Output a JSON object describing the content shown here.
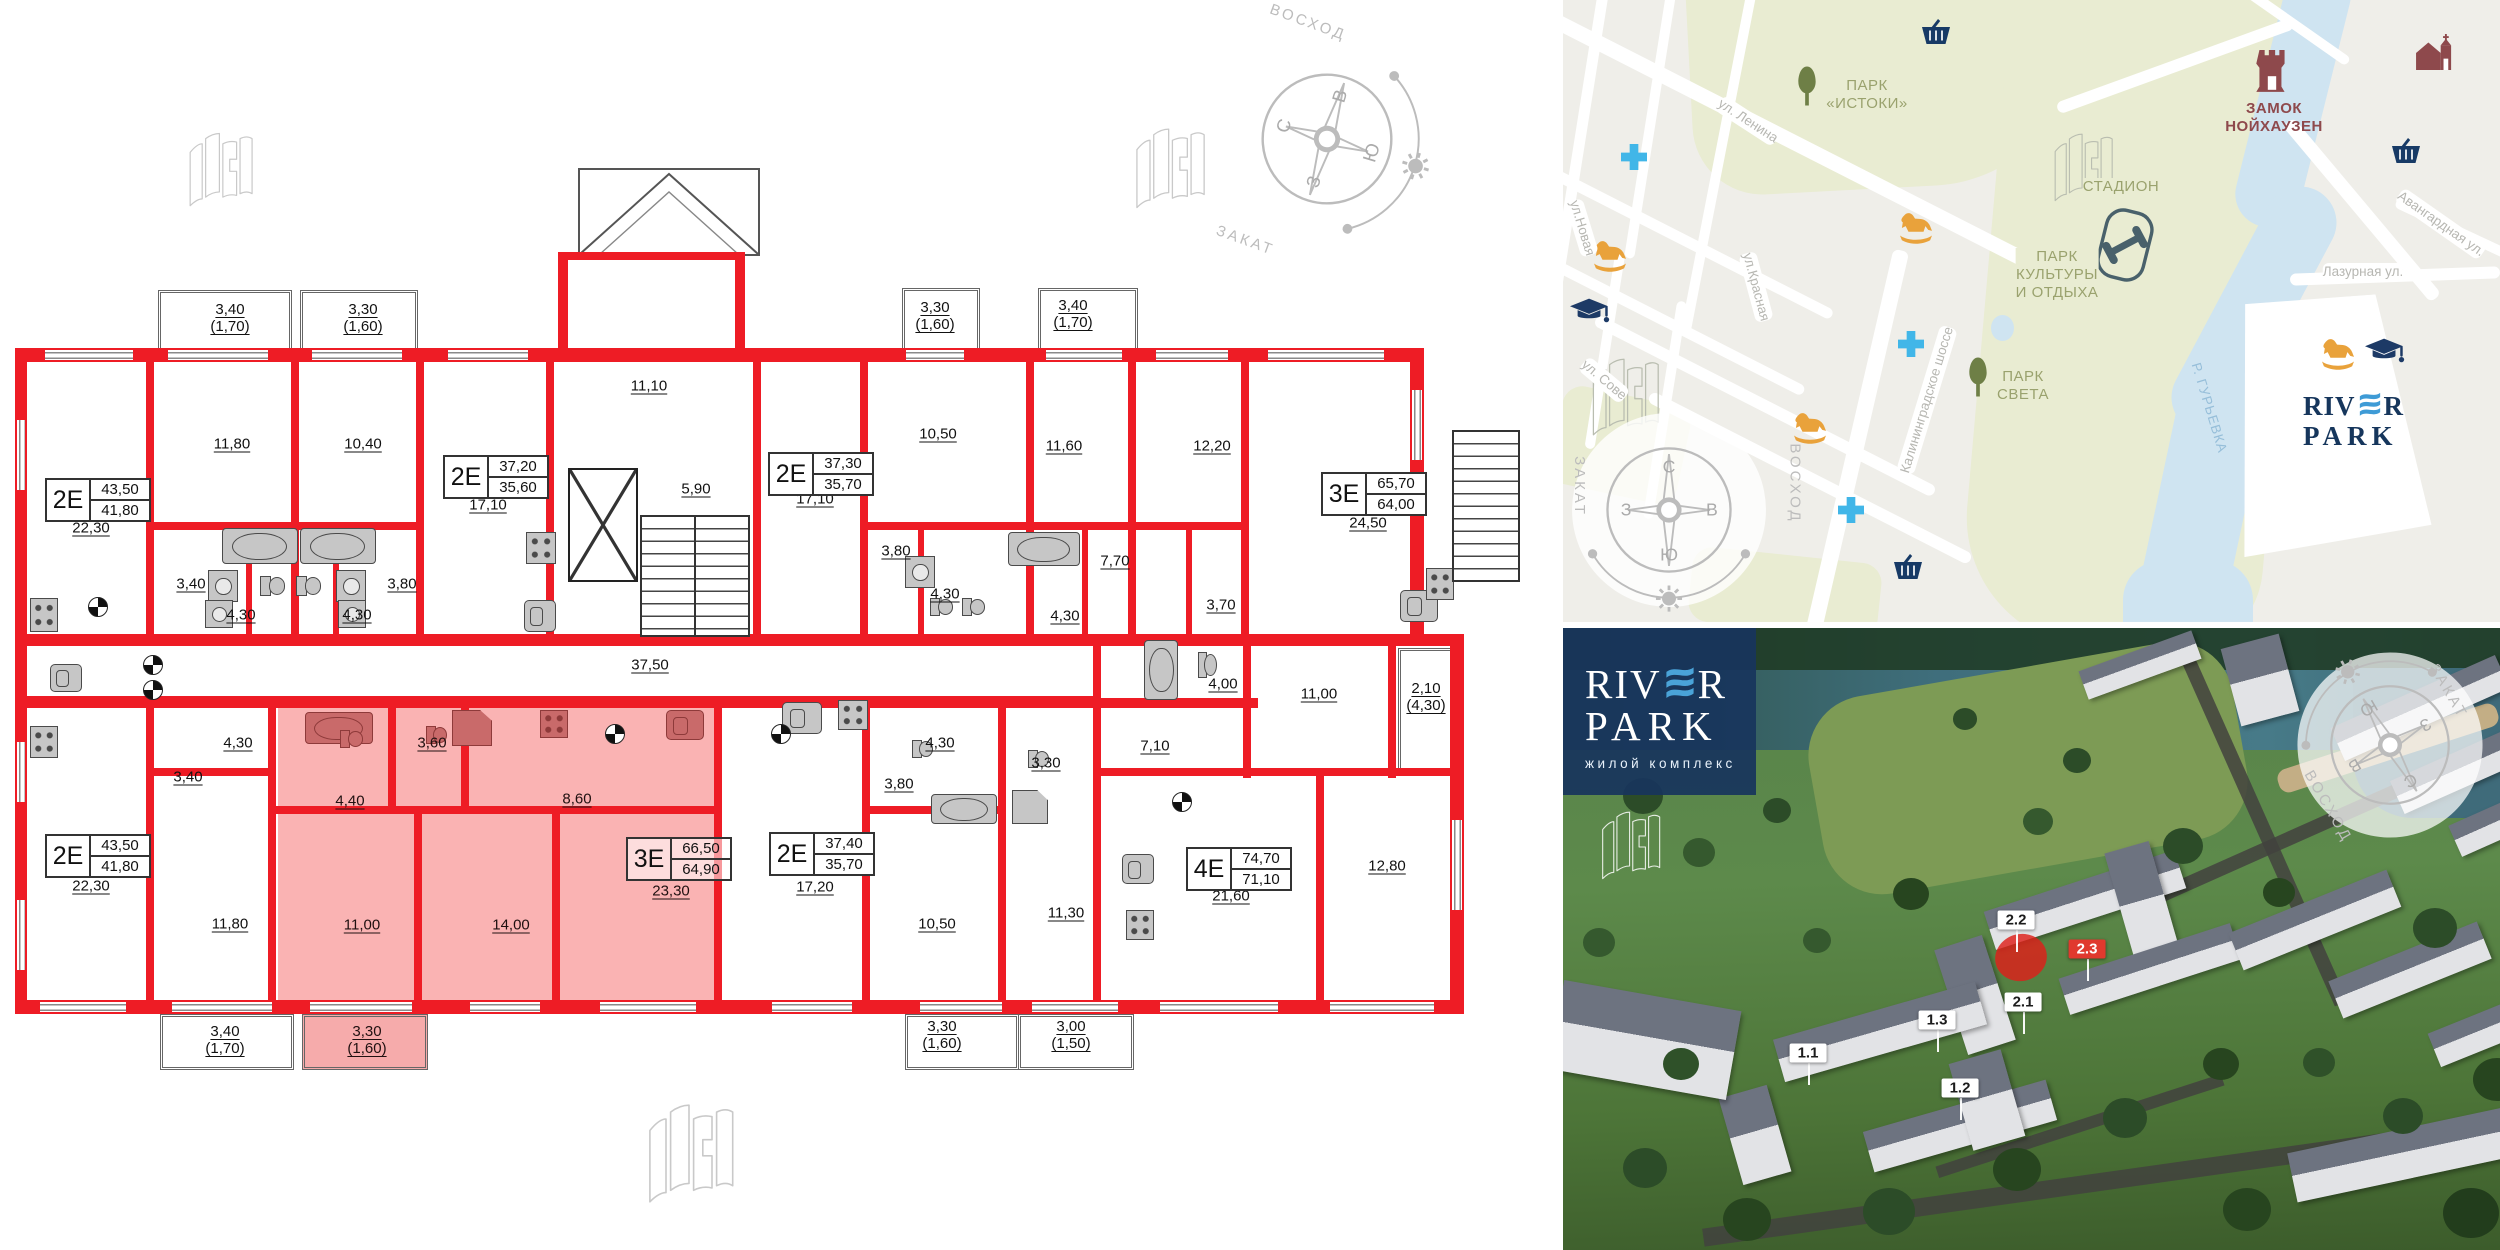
{
  "compass": {
    "north": "С",
    "east": "В",
    "south": "Ю",
    "west": "З",
    "sunrise": "ВОСХОД",
    "sunset": "ЗАКАТ"
  },
  "floor_plan": {
    "apartments": [
      {
        "code": "2Е",
        "area_total": "43,50",
        "area_living": "41,80",
        "x": 45,
        "y": 478
      },
      {
        "code": "2Е",
        "area_total": "37,20",
        "area_living": "35,60",
        "x": 443,
        "y": 455
      },
      {
        "code": "2Е",
        "area_total": "37,30",
        "area_living": "35,70",
        "x": 768,
        "y": 452
      },
      {
        "code": "3Е",
        "area_total": "65,70",
        "area_living": "64,00",
        "x": 1321,
        "y": 472
      },
      {
        "code": "2Е",
        "area_total": "43,50",
        "area_living": "41,80",
        "x": 45,
        "y": 834
      },
      {
        "code": "3Е",
        "area_total": "66,50",
        "area_living": "64,90",
        "x": 626,
        "y": 837,
        "highlighted": true
      },
      {
        "code": "2Е",
        "area_total": "37,40",
        "area_living": "35,70",
        "x": 769,
        "y": 832
      },
      {
        "code": "4Е",
        "area_total": "74,70",
        "area_living": "71,10",
        "x": 1186,
        "y": 847
      }
    ],
    "room_labels": [
      {
        "t": "22,30",
        "x": 91,
        "y": 528
      },
      {
        "t": "11,80",
        "x": 232,
        "y": 444
      },
      {
        "t": "10,40",
        "x": 363,
        "y": 444
      },
      {
        "t": "17,10",
        "x": 488,
        "y": 505
      },
      {
        "t": "3,40",
        "x": 191,
        "y": 584
      },
      {
        "t": "4,30",
        "x": 241,
        "y": 615
      },
      {
        "t": "4,30",
        "x": 357,
        "y": 615
      },
      {
        "t": "3,80",
        "x": 402,
        "y": 584
      },
      {
        "t": "11,10",
        "x": 649,
        "y": 386
      },
      {
        "t": "5,90",
        "x": 696,
        "y": 489
      },
      {
        "t": "17,10",
        "x": 815,
        "y": 499
      },
      {
        "t": "10,50",
        "x": 938,
        "y": 434
      },
      {
        "t": "3,80",
        "x": 896,
        "y": 551
      },
      {
        "t": "4,30",
        "x": 945,
        "y": 594
      },
      {
        "t": "11,60",
        "x": 1064,
        "y": 446
      },
      {
        "t": "12,20",
        "x": 1212,
        "y": 446
      },
      {
        "t": "24,50",
        "x": 1368,
        "y": 523
      },
      {
        "t": "7,70",
        "x": 1115,
        "y": 561
      },
      {
        "t": "4,30",
        "x": 1065,
        "y": 616
      },
      {
        "t": "3,70",
        "x": 1221,
        "y": 605
      },
      {
        "t": "37,50",
        "x": 650,
        "y": 665
      },
      {
        "t": "22,30",
        "x": 91,
        "y": 886
      },
      {
        "t": "3,40",
        "x": 188,
        "y": 777
      },
      {
        "t": "4,30",
        "x": 238,
        "y": 743
      },
      {
        "t": "11,80",
        "x": 230,
        "y": 924
      },
      {
        "t": "4,40",
        "x": 350,
        "y": 801,
        "hl": true
      },
      {
        "t": "3,60",
        "x": 432,
        "y": 743,
        "hl": true
      },
      {
        "t": "8,60",
        "x": 577,
        "y": 799,
        "hl": true
      },
      {
        "t": "11,00",
        "x": 362,
        "y": 925,
        "hl": true
      },
      {
        "t": "14,00",
        "x": 511,
        "y": 925,
        "hl": true
      },
      {
        "t": "23,30",
        "x": 671,
        "y": 891,
        "hl": true
      },
      {
        "t": "17,20",
        "x": 815,
        "y": 887
      },
      {
        "t": "3,80",
        "x": 899,
        "y": 784
      },
      {
        "t": "10,50",
        "x": 937,
        "y": 924
      },
      {
        "t": "4,30",
        "x": 940,
        "y": 743
      },
      {
        "t": "3,30",
        "x": 1046,
        "y": 763
      },
      {
        "t": "11,30",
        "x": 1066,
        "y": 913
      },
      {
        "t": "4,00",
        "x": 1223,
        "y": 684
      },
      {
        "t": "11,00",
        "x": 1319,
        "y": 694
      },
      {
        "t": "7,10",
        "x": 1155,
        "y": 746
      },
      {
        "t": "21,60",
        "x": 1231,
        "y": 896
      },
      {
        "t": "12,80",
        "x": 1387,
        "y": 866
      }
    ],
    "balcony_labels": [
      {
        "t": "3,40\n(1,70)",
        "x": 230,
        "y": 318
      },
      {
        "t": "3,30\n(1,60)",
        "x": 363,
        "y": 318
      },
      {
        "t": "3,30\n(1,60)",
        "x": 935,
        "y": 316
      },
      {
        "t": "3,40\n(1,70)",
        "x": 1073,
        "y": 314
      },
      {
        "t": "2,10\n(4,30)",
        "x": 1426,
        "y": 697
      },
      {
        "t": "3,40\n(1,70)",
        "x": 225,
        "y": 1040
      },
      {
        "t": "3,30\n(1,60)",
        "x": 367,
        "y": 1040,
        "hl": true
      },
      {
        "t": "3,30\n(1,60)",
        "x": 942,
        "y": 1035
      },
      {
        "t": "3,00\n(1,50)",
        "x": 1071,
        "y": 1035
      }
    ]
  },
  "map": {
    "labels": [
      {
        "t": "ПАРК\n«ИСТОКИ»",
        "x": 1867,
        "y": 95,
        "cls": "park"
      },
      {
        "t": "ПАРК\nКУЛЬТУРЫ\nИ ОТДЫХА",
        "x": 2057,
        "y": 275,
        "cls": "park"
      },
      {
        "t": "ПАРК\nСВЕТА",
        "x": 2023,
        "y": 386,
        "cls": "park"
      },
      {
        "t": "СТАДИОН",
        "x": 2121,
        "y": 187,
        "cls": "park"
      },
      {
        "t": "ЗАМОК\nНОЙХАУЗЕН",
        "x": 2274,
        "y": 118,
        "cls": "castle"
      },
      {
        "t": "ул. Ленина",
        "x": 1748,
        "y": 121,
        "rot": 33,
        "cls": "street"
      },
      {
        "t": "ул.Новая",
        "x": 1582,
        "y": 228,
        "rot": 73,
        "cls": "street"
      },
      {
        "t": "ул.Красная",
        "x": 1756,
        "y": 287,
        "rot": 75,
        "cls": "street"
      },
      {
        "t": "Калининградское шоссе",
        "x": 1927,
        "y": 400,
        "rot": -73,
        "cls": "street"
      },
      {
        "t": "Авангардная ул.",
        "x": 2441,
        "y": 224,
        "rot": 35,
        "cls": "street"
      },
      {
        "t": "Лазурная ул.",
        "x": 2363,
        "y": 272,
        "rot": 0,
        "cls": "street"
      },
      {
        "t": "ул. Сове",
        "x": 1604,
        "y": 380,
        "rot": 40,
        "cls": "street"
      },
      {
        "t": "Р. ГУРЬЕВКА",
        "x": 2209,
        "y": 408,
        "rot": 73,
        "cls": "river"
      }
    ],
    "icons": [
      {
        "icon": "tree-icon",
        "x": 1807,
        "y": 86
      },
      {
        "icon": "tree-icon",
        "x": 1978,
        "y": 377
      },
      {
        "icon": "medical-cross-icon",
        "x": 1634,
        "y": 157
      },
      {
        "icon": "medical-cross-icon",
        "x": 1911,
        "y": 344
      },
      {
        "icon": "medical-cross-icon",
        "x": 1851,
        "y": 510
      },
      {
        "icon": "playground-horse-icon",
        "x": 1610,
        "y": 256
      },
      {
        "icon": "playground-horse-icon",
        "x": 1916,
        "y": 228
      },
      {
        "icon": "playground-horse-icon",
        "x": 1810,
        "y": 428
      },
      {
        "icon": "playground-horse-icon",
        "x": 2338,
        "y": 354
      },
      {
        "icon": "school-cap-icon",
        "x": 1590,
        "y": 312
      },
      {
        "icon": "school-cap-icon",
        "x": 2385,
        "y": 352
      },
      {
        "icon": "shop-basket-icon",
        "x": 1936,
        "y": 32
      },
      {
        "icon": "shop-basket-icon",
        "x": 2406,
        "y": 151
      },
      {
        "icon": "shop-basket-icon",
        "x": 1908,
        "y": 567
      },
      {
        "icon": "castle-icon",
        "x": 2272,
        "y": 72
      },
      {
        "icon": "church-icon",
        "x": 2435,
        "y": 52
      },
      {
        "icon": "stadium-icon",
        "x": 2125,
        "y": 245
      }
    ],
    "logo": {
      "l1a": "RIV",
      "l1b": "R",
      "l2": "PARK"
    }
  },
  "photo": {
    "logo": {
      "l1a": "RIV",
      "l1b": "R",
      "l2": "PARK",
      "subtitle": "жилой комплекс"
    },
    "building_labels": [
      {
        "t": "2.2",
        "x": 2016,
        "y": 920
      },
      {
        "t": "2.3",
        "x": 2087,
        "y": 949,
        "hl": true
      },
      {
        "t": "2.1",
        "x": 2023,
        "y": 1002
      },
      {
        "t": "1.3",
        "x": 1937,
        "y": 1020
      },
      {
        "t": "1.1",
        "x": 1808,
        "y": 1053
      },
      {
        "t": "1.2",
        "x": 1960,
        "y": 1088
      }
    ]
  },
  "colors": {
    "wall_red": "#ee1c25",
    "apartment_highlight": "#f6abab",
    "map_park_green": "#e9ecd2",
    "map_water_blue": "#cfe4f1",
    "accent_orange": "#e9a23b",
    "accent_light_blue": "#41b6e8",
    "accent_navy": "#1d3a66",
    "accent_dark_red": "#8e494c",
    "logo_navy": "#16365c",
    "logo_wave_blue": "#3e9bd6",
    "label_red": "#e0392e"
  }
}
